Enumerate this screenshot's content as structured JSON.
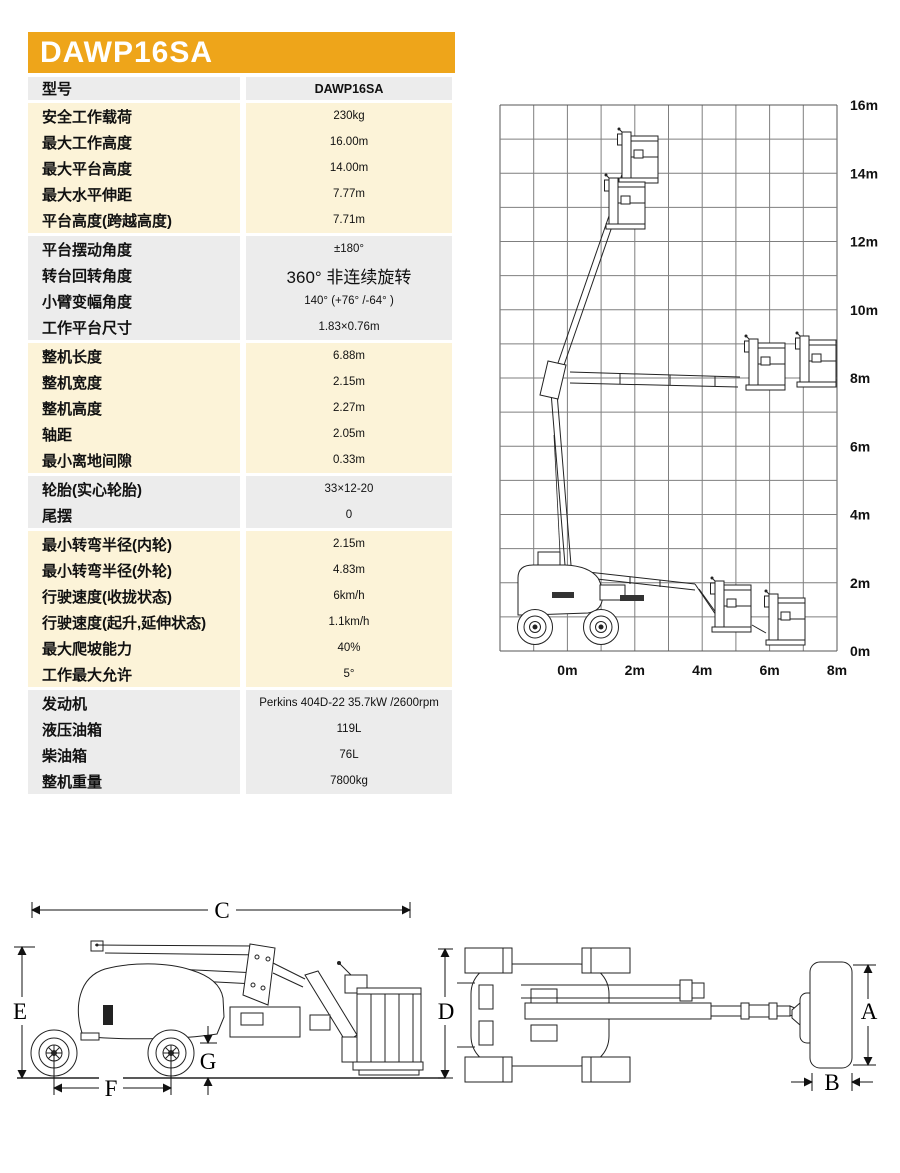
{
  "banner": {
    "model": "DAWP16SA"
  },
  "colors": {
    "accent_gold": "#EEA51A",
    "row_yellow": "#FCF3D8",
    "row_gray": "#ECECEC"
  },
  "spec_table": {
    "header_row": {
      "label": "型号",
      "value": "DAWP16SA"
    },
    "groups": [
      {
        "tone": "yellow",
        "rows": [
          {
            "label": "安全工作载荷",
            "value": "230kg"
          },
          {
            "label": "最大工作高度",
            "value": "16.00m"
          },
          {
            "label": "最大平台高度",
            "value": "14.00m"
          },
          {
            "label": "最大水平伸距",
            "value": "7.77m"
          },
          {
            "label": "平台高度(跨越高度)",
            "value": "7.71m"
          }
        ]
      },
      {
        "tone": "gray",
        "rows": [
          {
            "label": "平台摆动角度",
            "value": "±180°"
          },
          {
            "label": "转台回转角度",
            "value": "360° 非连续旋转",
            "big": true
          },
          {
            "label": "小臂变幅角度",
            "value": "140° (+76° /-64° )"
          },
          {
            "label": "工作平台尺寸",
            "value": "1.83×0.76m"
          }
        ]
      },
      {
        "tone": "yellow",
        "rows": [
          {
            "label": "整机长度",
            "value": "6.88m"
          },
          {
            "label": "整机宽度",
            "value": "2.15m"
          },
          {
            "label": "整机高度",
            "value": "2.27m"
          },
          {
            "label": "轴距",
            "value": "2.05m"
          },
          {
            "label": "最小离地间隙",
            "value": "0.33m"
          }
        ]
      },
      {
        "tone": "gray",
        "rows": [
          {
            "label": "轮胎(实心轮胎)",
            "value": "33×12-20"
          },
          {
            "label": "尾摆",
            "value": "0"
          }
        ]
      },
      {
        "tone": "yellow",
        "rows": [
          {
            "label": "最小转弯半径(内轮)",
            "value": "2.15m"
          },
          {
            "label": "最小转弯半径(外轮)",
            "value": "4.83m"
          },
          {
            "label": "行驶速度(收拢状态)",
            "value": "6km/h"
          },
          {
            "label": "行驶速度(起升,延伸状态)",
            "value": "1.1km/h"
          },
          {
            "label": "最大爬坡能力",
            "value": "40%"
          },
          {
            "label": "工作最大允许",
            "value": "5°"
          }
        ]
      },
      {
        "tone": "gray",
        "rows": [
          {
            "label": "发动机",
            "value": "Perkins 404D-22 35.7kW /2600rpm"
          },
          {
            "label": "液压油箱",
            "value": "119L"
          },
          {
            "label": "柴油箱",
            "value": "76L"
          },
          {
            "label": "整机重量",
            "value": "7800kg"
          }
        ]
      }
    ]
  },
  "envelope": {
    "type": "working-envelope-diagram",
    "y_ticks": [
      "16m",
      "14m",
      "12m",
      "10m",
      "8m",
      "6m",
      "4m",
      "2m",
      "0m"
    ],
    "x_ticks": [
      "0m",
      "2m",
      "4m",
      "6m",
      "8m"
    ],
    "x_range_m": [
      -2,
      8
    ],
    "y_range_m": [
      0,
      16
    ],
    "grid_step_m": 1
  },
  "dims": {
    "c": "C",
    "e": "E",
    "f": "F",
    "g": "G",
    "d": "D",
    "a": "A",
    "b": "B"
  }
}
